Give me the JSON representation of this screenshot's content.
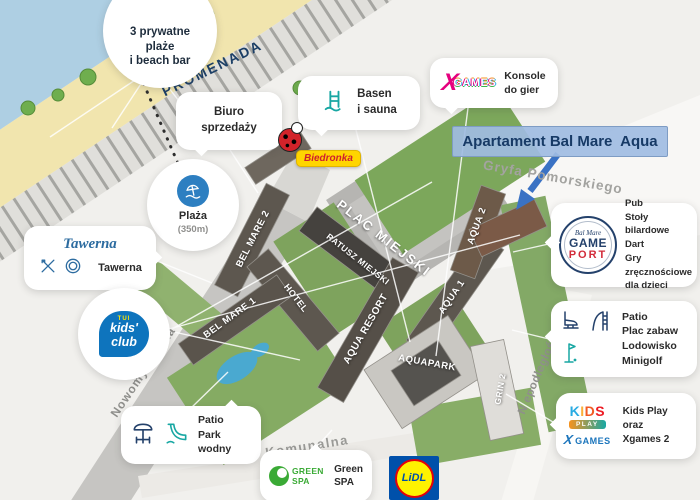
{
  "streets": {
    "promenada": "PROMENADA",
    "gryfa_pomorskiego": "Gryfa Pomorskiego",
    "nowomysliwska": "Nowomyśliwska",
    "niepodleglosci": "N epodległości",
    "komunalna": "Komunalna"
  },
  "buildings": {
    "bel_mare_2": "BEL MARE 2",
    "plac_miejski": "PLAC MIEJSKI",
    "ratusz_miejski": "RATUSZ MIEJSKI",
    "bel_mare_1": "BEL MARE 1",
    "hotel": "HOTEL",
    "aqua_resort": "AQUA RESORT",
    "aquapark": "AQUAPARK",
    "aqua_1": "AQUA 1",
    "aqua_2": "AQUA 2",
    "grin_2": "GRIN 2"
  },
  "highlight": {
    "label": "Apartament Bal Mare  Aqua"
  },
  "callouts": {
    "beaches": {
      "line1": "3 prywatne",
      "line2": "plaże",
      "line3": "i beach bar"
    },
    "sales_office": {
      "line1": "Biuro",
      "line2": "sprzedaży"
    },
    "pool_sauna": {
      "line1": "Basen",
      "line2": "i sauna"
    },
    "biedronka": {
      "label": "Biedronka"
    },
    "xgames_top": {
      "logo_x": "X",
      "logo_games": "GAMES",
      "line1": "Konsole",
      "line2": "do gier"
    },
    "beach_distance": {
      "title": "Plaża",
      "subtitle": "(350m)"
    },
    "tawerna": {
      "logo": "Tawerna",
      "label": "Tawerna"
    },
    "gameport": {
      "logo_script": "Bal Mare",
      "logo_game": "GAME",
      "logo_port": "PORT",
      "line1": "Pub",
      "line2": "Stoły bilardowe",
      "line3": "Dart",
      "line4": "Gry zręcznościowe",
      "line5": "dla dzieci"
    },
    "kids_club": {
      "logo_tui": "TUI",
      "logo_line1": "kids'",
      "logo_line2": "club"
    },
    "patio_attractions": {
      "line1": "Patio",
      "line2": "Plac zabaw",
      "line3": "Lodowisko",
      "line4": "Minigolf"
    },
    "kids_play": {
      "letters": [
        "K",
        "I",
        "D",
        "S"
      ],
      "logo_play": "PLAY",
      "logo_x": "X",
      "logo_games": "GAMES",
      "line1": "Kids Play",
      "line2": "oraz",
      "line3": "Xgames 2"
    },
    "patio_waterpark": {
      "line1": "Patio",
      "line2": "Park wodny"
    },
    "green_spa": {
      "logo": "GREEN SPA",
      "line1": "Green",
      "line2": "SPA"
    },
    "lidl": {
      "label": "LiDL"
    }
  },
  "colors": {
    "highlight_bg": "#a9c2e4",
    "highlight_text": "#173a66",
    "arrow": "#3a72c4",
    "biedronka_yellow": "#ffd500",
    "biedronka_red": "#cf1f2e",
    "lidl_blue": "#0050aa",
    "lidl_yellow": "#fff200",
    "lidl_red": "#e3000b",
    "xgames_pink": "#e5007e",
    "tui_blue": "#0e74bd",
    "green_spa_green": "#3aaa35",
    "gameport_navy": "#24416b",
    "gameport_red": "#d22c3a",
    "icon_teal": "#18a7a3",
    "icon_navy": "#24416b",
    "sea": "#aecfe3",
    "beach_sand": "#f1e5ae"
  }
}
